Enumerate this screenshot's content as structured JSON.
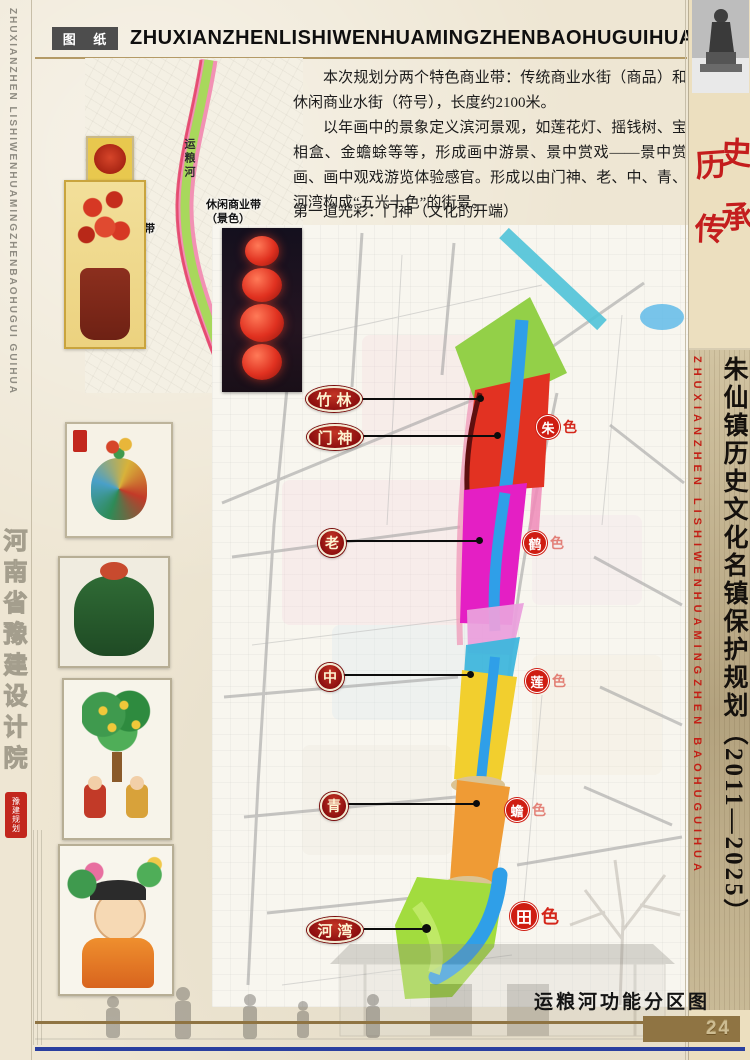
{
  "header": {
    "sheet_tag": "图 纸",
    "title": "ZHUXIANZHENLISHIWENHUAMINGZHENBAOHUGUIHUA"
  },
  "left_margin": {
    "pinyin": "ZHUXIANZHEN  LISHIWENHUAMINGZHENBAOHUGUI  GUIHUA",
    "institute": "河南省豫建设计院",
    "seal": "豫建规划"
  },
  "right_column": {
    "heritage_chars": [
      "历",
      "史",
      "传",
      "承"
    ],
    "title_vertical": "朱仙镇历史文化名镇保护规划（2011—2025）",
    "pinyin_vertical": "ZHUXIANZHEN  LISHIWENHUAMINGZHEN  BAOHUGUIHUA"
  },
  "intro": {
    "paragraphs": [
      "本次规划分两个特色商业带：传统商业水街（商品）和休闲商业水街（符号），长度约2100米。",
      "以年画中的景象定义滨河景观，如莲花灯、摇钱树、宝相盒、金蟾蜍等等，形成画中游景、景中赏戏——景中赏画、画中观戏游览体验感官。形成以由门神、老、中、青、河湾构成“五光十色”的街景。"
    ],
    "light_list": [
      "第一道光彩：门神（文化的开端）",
      "第二道光彩：老年",
      "第三道光彩：中年",
      "第四道光彩：青年",
      "第五道光彩：河湾（天然的收尾）"
    ]
  },
  "strip_map": {
    "river_label": "运粮河",
    "traditional_band": "传统商业带",
    "traditional_band_sub": "（诗画）",
    "leisure_band": "休闲商业带",
    "leisure_band_sub": "（景色）"
  },
  "map": {
    "zones": [
      {
        "label": "竹林"
      },
      {
        "label": "门神"
      },
      {
        "label": "老"
      },
      {
        "label": "中"
      },
      {
        "label": "青"
      },
      {
        "label": "河湾"
      }
    ],
    "badges": [
      {
        "char": "朱",
        "suffix": "色"
      },
      {
        "char": "鹤",
        "suffix": "色"
      },
      {
        "char": "莲",
        "suffix": "色"
      },
      {
        "char": "蟾",
        "suffix": "色"
      },
      {
        "char": "田",
        "suffix": "色"
      }
    ]
  },
  "footer": {
    "caption": "运粮河功能分区图",
    "page_number": "24"
  },
  "palette": {
    "paper": "#eee6d3",
    "accent_red": "#c41d1d",
    "badge_red": "#cf1d12",
    "zone_red": "#8d0f0f",
    "tan_bar": "#8f7443",
    "blue_rule": "#2a3f9f",
    "river_water": "#2f9fe8",
    "segment_bamboo_green": "#93d048",
    "segment_menshen_red": "#e23222",
    "segment_lao_magenta": "#e41fc4",
    "segment_zhong_yellow": "#f2cf2e",
    "segment_qing_orange": "#ef9b35",
    "segment_hewan_green": "#a2dc3e",
    "band_pink": "#f08bb8"
  }
}
